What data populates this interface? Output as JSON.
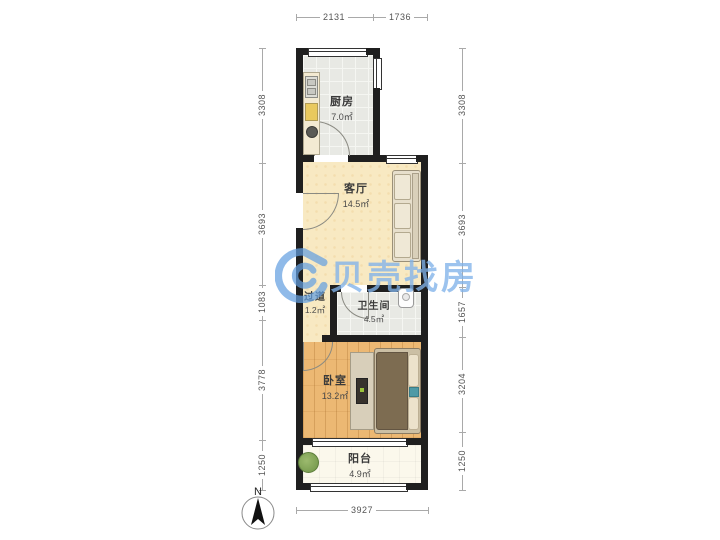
{
  "watermark": {
    "brand": "贝壳找房",
    "color": "#80b2e9"
  },
  "compass": {
    "label": "N"
  },
  "rooms": {
    "kitchen": {
      "name": "厨房",
      "area": "7.0㎡"
    },
    "living": {
      "name": "客厅",
      "area": "14.5㎡"
    },
    "hallway": {
      "name": "过道",
      "area": "1.2㎡"
    },
    "bathroom": {
      "name": "卫生间",
      "area": "4.5㎡"
    },
    "bedroom": {
      "name": "卧室",
      "area": "13.2㎡"
    },
    "balcony": {
      "name": "阳台",
      "area": "4.9㎡"
    }
  },
  "dimensions": {
    "top": [
      "2131",
      "1736"
    ],
    "bottom": [
      "3927"
    ],
    "left": [
      "3308",
      "3693",
      "1083",
      "3778",
      "1250"
    ],
    "right": [
      "3308",
      "3693",
      "1657",
      "3204",
      "1250"
    ]
  },
  "colors": {
    "wall": "#1f1f1f",
    "tile_floor": "#e8e9e4",
    "cream_floor": "#f8e9c2",
    "wood_floor": "#ecb873",
    "balcony_floor": "#fbf8ec"
  }
}
